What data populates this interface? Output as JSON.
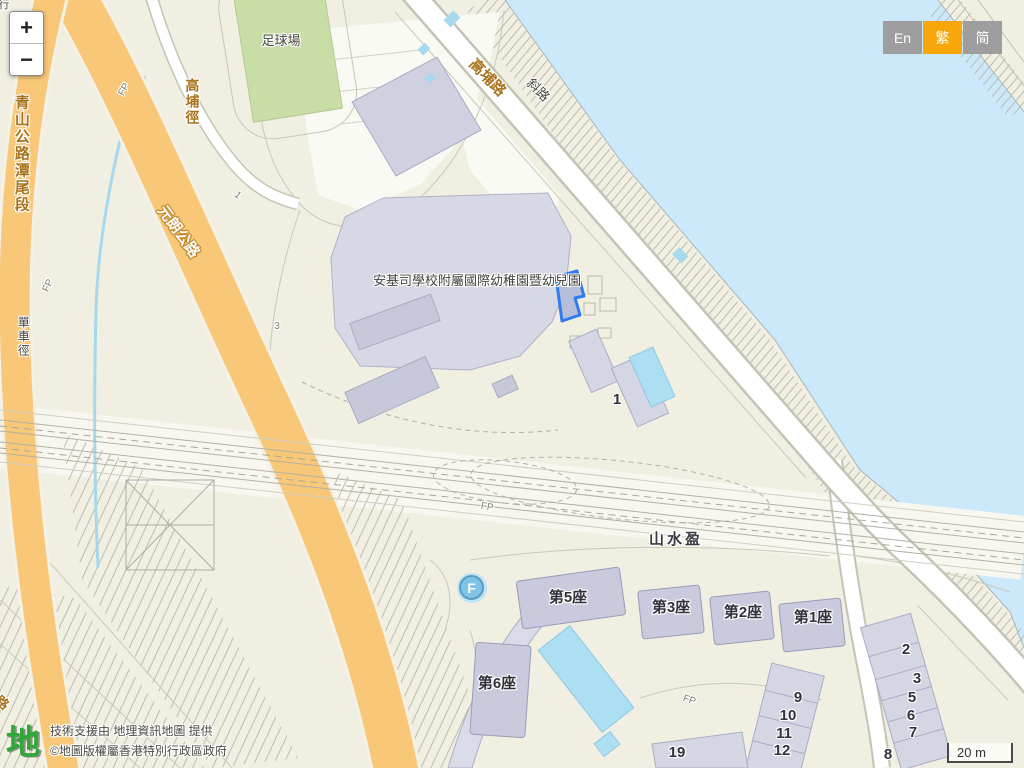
{
  "controls": {
    "zoom_in": "+",
    "zoom_out": "−",
    "languages": [
      {
        "label": "En",
        "active": false
      },
      {
        "label": "繁",
        "active": true
      },
      {
        "label": "简",
        "active": false
      }
    ]
  },
  "scale_bar": {
    "label": "20 m"
  },
  "attribution": {
    "logo_glyph": "地",
    "line1": "技術支援由 地理資訊地圖 提供",
    "line2": "©地圖版權屬香港特別行政區政府"
  },
  "markers": {
    "fountain_letter": "F"
  },
  "map_colors": {
    "water": "#cbe9fb",
    "land": "#f0efe2",
    "highway_orange": "#f8c878",
    "building": "#d5d6e4",
    "selected_outline": "#2e7cf0",
    "field_green": "#c9dda7",
    "pool": "#addff3"
  },
  "map": {
    "labels": [
      {
        "t": "足球場",
        "x": 281,
        "y": 41,
        "c": "poi",
        "s": 13
      },
      {
        "t": "高埔路",
        "x": 487,
        "y": 78,
        "c": "road",
        "r": 46,
        "s": 15
      },
      {
        "t": "斜路",
        "x": 538,
        "y": 90,
        "c": "poi",
        "r": 45,
        "s": 13
      },
      {
        "t": "青山公路潭尾段",
        "x": 21,
        "y": 154,
        "c": "road",
        "v": true,
        "s": 15
      },
      {
        "t": "高埔徑",
        "x": 192,
        "y": 102,
        "c": "road",
        "v": true,
        "s": 14
      },
      {
        "t": "元朗公路",
        "x": 178,
        "y": 232,
        "c": "road-inverse",
        "r": 54,
        "s": 15
      },
      {
        "t": "單車徑",
        "x": 23,
        "y": 337,
        "c": "poi",
        "v": true,
        "s": 12
      },
      {
        "t": "安基司學校附屬國際幼稚園暨幼兒園",
        "x": 477,
        "y": 281,
        "c": "poi",
        "s": 13
      },
      {
        "t": "山水盈",
        "x": 676,
        "y": 540,
        "c": "estate",
        "s": 15
      },
      {
        "t": "第5座",
        "x": 568,
        "y": 598,
        "c": "tower"
      },
      {
        "t": "第3座",
        "x": 671,
        "y": 608,
        "c": "tower"
      },
      {
        "t": "第2座",
        "x": 743,
        "y": 613,
        "c": "tower"
      },
      {
        "t": "第1座",
        "x": 813,
        "y": 618,
        "c": "tower"
      },
      {
        "t": "第6座",
        "x": 497,
        "y": 684,
        "c": "tower"
      },
      {
        "t": "1",
        "x": 617,
        "y": 400,
        "c": "num"
      },
      {
        "t": "2",
        "x": 906,
        "y": 650,
        "c": "num"
      },
      {
        "t": "3",
        "x": 917,
        "y": 679,
        "c": "num"
      },
      {
        "t": "5",
        "x": 912,
        "y": 698,
        "c": "num"
      },
      {
        "t": "6",
        "x": 911,
        "y": 716,
        "c": "num"
      },
      {
        "t": "7",
        "x": 913,
        "y": 733,
        "c": "num"
      },
      {
        "t": "8",
        "x": 888,
        "y": 755,
        "c": "num"
      },
      {
        "t": "9",
        "x": 798,
        "y": 698,
        "c": "num"
      },
      {
        "t": "10",
        "x": 788,
        "y": 716,
        "c": "num"
      },
      {
        "t": "11",
        "x": 784,
        "y": 734,
        "c": "num"
      },
      {
        "t": "12",
        "x": 782,
        "y": 751,
        "c": "num"
      },
      {
        "t": "19",
        "x": 677,
        "y": 753,
        "c": "num"
      },
      {
        "t": "FP",
        "x": 125,
        "y": 90,
        "c": "fp",
        "r": -60
      },
      {
        "t": "FP",
        "x": 49,
        "y": 286,
        "c": "fp",
        "r": -65
      },
      {
        "t": "FP",
        "x": 487,
        "y": 508,
        "c": "fp",
        "r": 10
      },
      {
        "t": "FP",
        "x": 689,
        "y": 701,
        "c": "fp",
        "r": 20
      },
      {
        "t": "1",
        "x": 237,
        "y": 196,
        "c": "fp",
        "r": 40
      },
      {
        "t": "3",
        "x": 277,
        "y": 327,
        "c": "fp"
      },
      {
        "t": "行",
        "x": 4,
        "y": 6,
        "c": "poi",
        "s": 11
      },
      {
        "t": "路",
        "x": 2,
        "y": 703,
        "c": "road",
        "r": 40,
        "s": 13
      }
    ]
  }
}
